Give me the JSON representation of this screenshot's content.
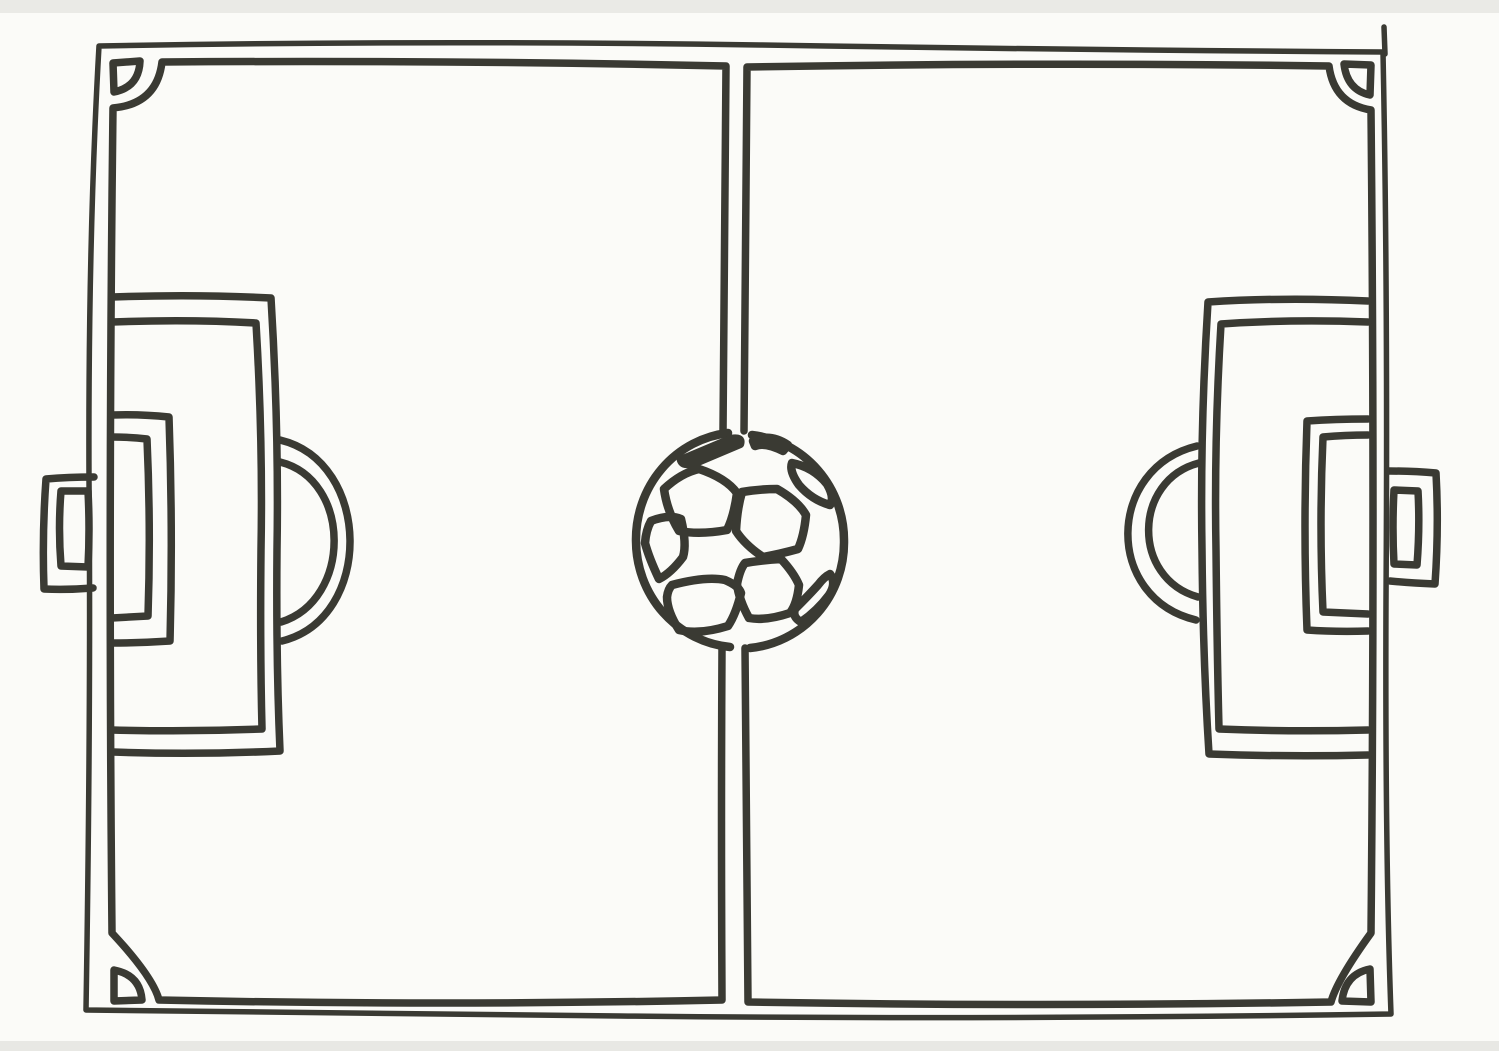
{
  "colors": {
    "paper": "#fbfbf8",
    "ink": "#3a3a33",
    "scanband": "#d9d9d4"
  },
  "drawing": {
    "subject": "hand-drawn soccer field top view with soccer ball at center spot",
    "style": "black marker outline coloring page, no text",
    "elements": [
      "field-outer-boundary",
      "touchline-left-half",
      "touchline-right-half",
      "halfway-line-double",
      "corner-arc-top-left",
      "corner-arc-top-right",
      "corner-arc-bottom-left",
      "corner-arc-bottom-right",
      "penalty-area-left",
      "goal-area-left",
      "penalty-arc-left",
      "goal-left",
      "penalty-area-right",
      "goal-area-right",
      "penalty-arc-right",
      "goal-right",
      "soccer-ball-icon"
    ]
  }
}
